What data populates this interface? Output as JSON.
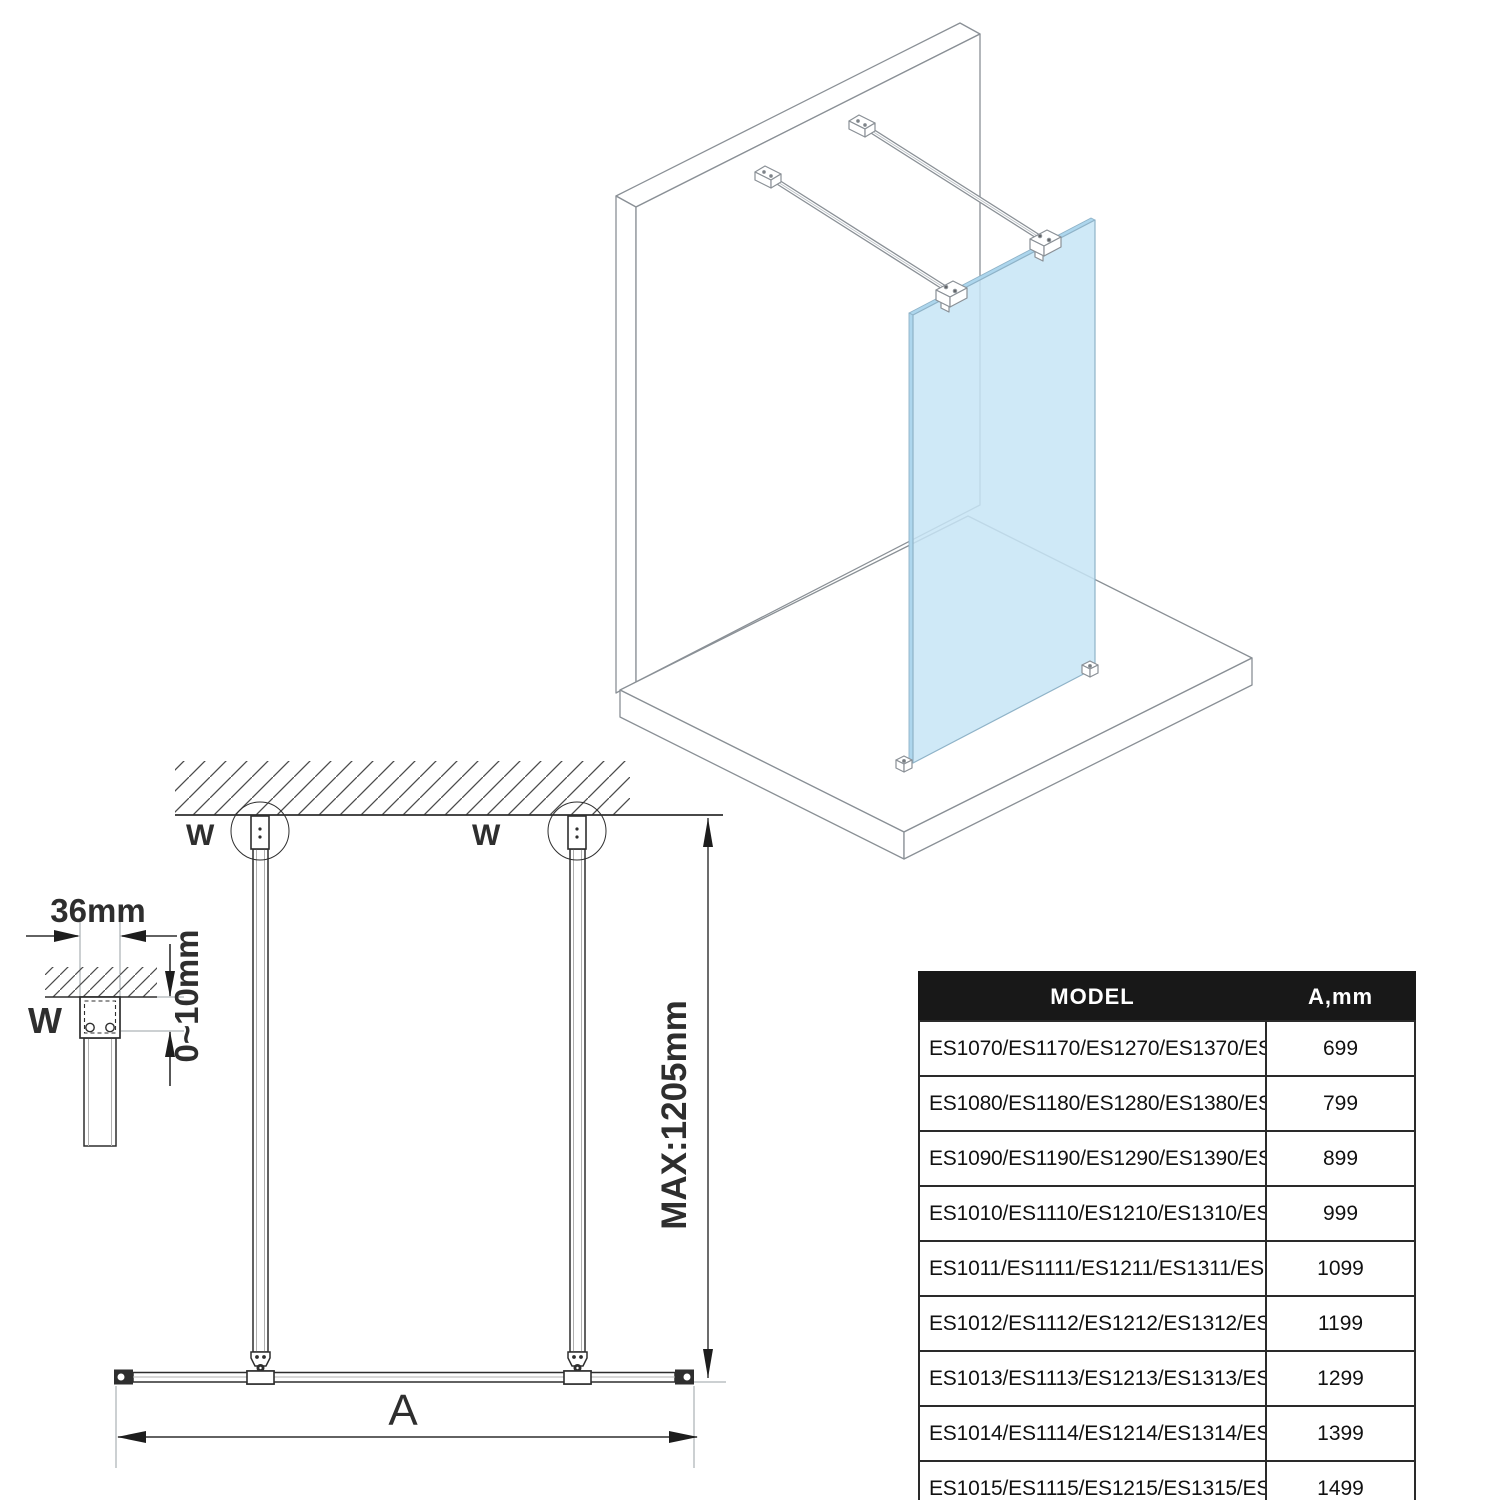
{
  "iso_view": {
    "glass_color": "#c7e5f6",
    "line_color": "#8a9096"
  },
  "front_view": {
    "labels": {
      "wall_bracket": "W",
      "max_height": "MAX:1205mm",
      "width_var": "A"
    }
  },
  "detail_view": {
    "labels": {
      "wall_bracket": "W",
      "profile_width": "36mm",
      "adjust_gap": "0~10mm"
    }
  },
  "spec_table": {
    "columns": [
      "MODEL",
      "A,mm"
    ],
    "rows": [
      {
        "model": "ES1070/ES1170/ES1270/ES1370/ES1570",
        "a_mm": "699"
      },
      {
        "model": "ES1080/ES1180/ES1280/ES1380/ES1580",
        "a_mm": "799"
      },
      {
        "model": "ES1090/ES1190/ES1290/ES1390/ES1590",
        "a_mm": "899"
      },
      {
        "model": "ES1010/ES1110/ES1210/ES1310/ES1510",
        "a_mm": "999"
      },
      {
        "model": "ES1011/ES1111/ES1211/ES1311/ES1511",
        "a_mm": "1099"
      },
      {
        "model": "ES1012/ES1112/ES1212/ES1312/ES1512",
        "a_mm": "1199"
      },
      {
        "model": "ES1013/ES1113/ES1213/ES1313/ES1513",
        "a_mm": "1299"
      },
      {
        "model": "ES1014/ES1114/ES1214/ES1314/ES1514",
        "a_mm": "1399"
      },
      {
        "model": "ES1015/ES1115/ES1215/ES1315/ES1515",
        "a_mm": "1499"
      }
    ]
  }
}
